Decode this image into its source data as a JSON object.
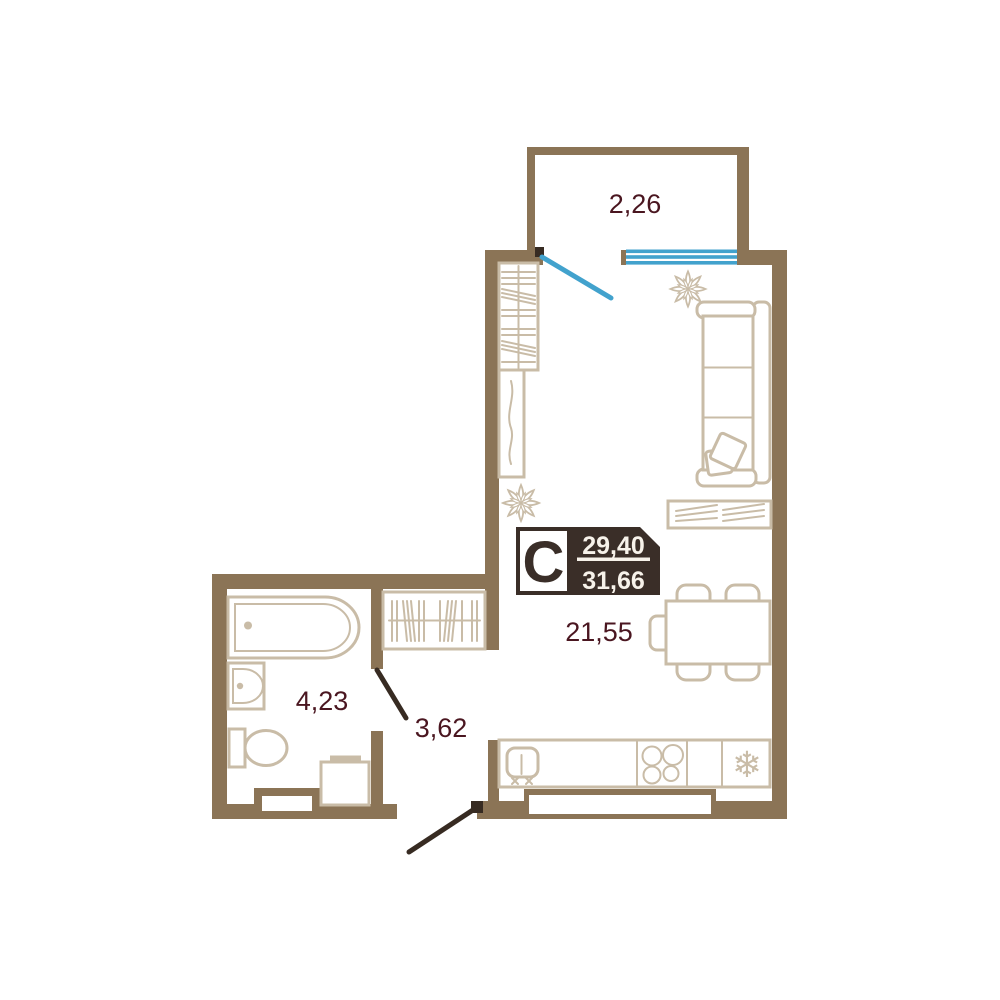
{
  "floor_plan": {
    "unit_badge": {
      "type_letter": "С",
      "living_area": "29,40",
      "total_area": "31,66"
    },
    "rooms": {
      "balcony": {
        "area": "2,26"
      },
      "living_room": {
        "area": "21,55"
      },
      "bathroom": {
        "area": "4,23"
      },
      "hallway": {
        "area": "3,62"
      }
    },
    "icons": {
      "fridge_snowflake": "❄"
    },
    "colors": {
      "wall": "#8b7456",
      "furniture_outline": "#c9bca7",
      "badge_background": "#3a2e28",
      "area_text": "#4a1620",
      "window_glazing": "#42a2cd",
      "door_leaf": "#372b22",
      "background": "#ffffff"
    }
  }
}
